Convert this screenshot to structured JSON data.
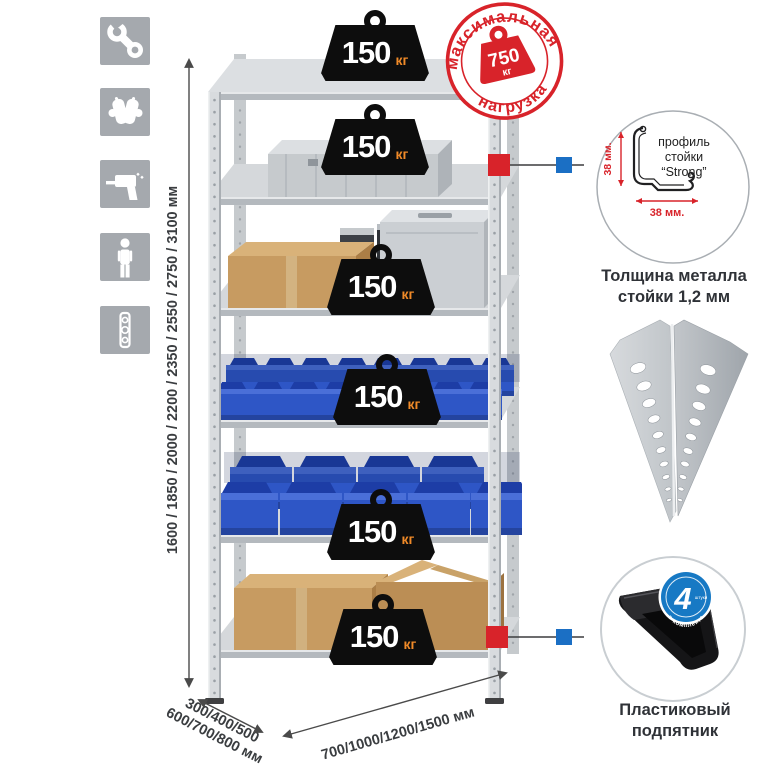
{
  "left_icons": [
    {
      "name": "wrench-icon"
    },
    {
      "name": "gloves-icon"
    },
    {
      "name": "drill-icon"
    },
    {
      "name": "person-height-icon"
    },
    {
      "name": "spirit-level-icon"
    }
  ],
  "rack": {
    "shelf_count": 6,
    "shelf_load_value": "150",
    "shelf_load_unit": "кг"
  },
  "max_load_stamp": {
    "arc_top": "максимальная",
    "arc_bottom": "нагрузка",
    "value": "750",
    "unit": "кг"
  },
  "dimensions": {
    "height_label": "1600 / 1850 / 2000 / 2200 / 2350 / 2550 / 2750 / 3100 мм",
    "depth_label_line1": "300/400/500",
    "depth_label_line2": "600/700/800 мм",
    "width_label": "700/1000/1200/1500 мм"
  },
  "profile_callout": {
    "label_line1": "профиль",
    "label_line2": "стойки",
    "label_line3": "“Strong”",
    "dim_vertical": "38 мм.",
    "dim_horizontal": "38 мм.",
    "caption_line1": "Толщина металла",
    "caption_line2": "стойки 1,2 мм"
  },
  "foot_callout": {
    "badge_value": "4",
    "badge_unit": "штуки",
    "badge_arc": "в комплекте",
    "caption_line1": "Пластиковый",
    "caption_line2": "подпятник"
  },
  "colors": {
    "accent_red": "#d8232a",
    "accent_blue": "#1b6fc4",
    "bin_blue": "#2e56c6",
    "metal_gray": "#d2d6da",
    "cardboard": "#c79b61",
    "kg_orange": "#f08a28",
    "badge_black": "#0d0d0d"
  }
}
